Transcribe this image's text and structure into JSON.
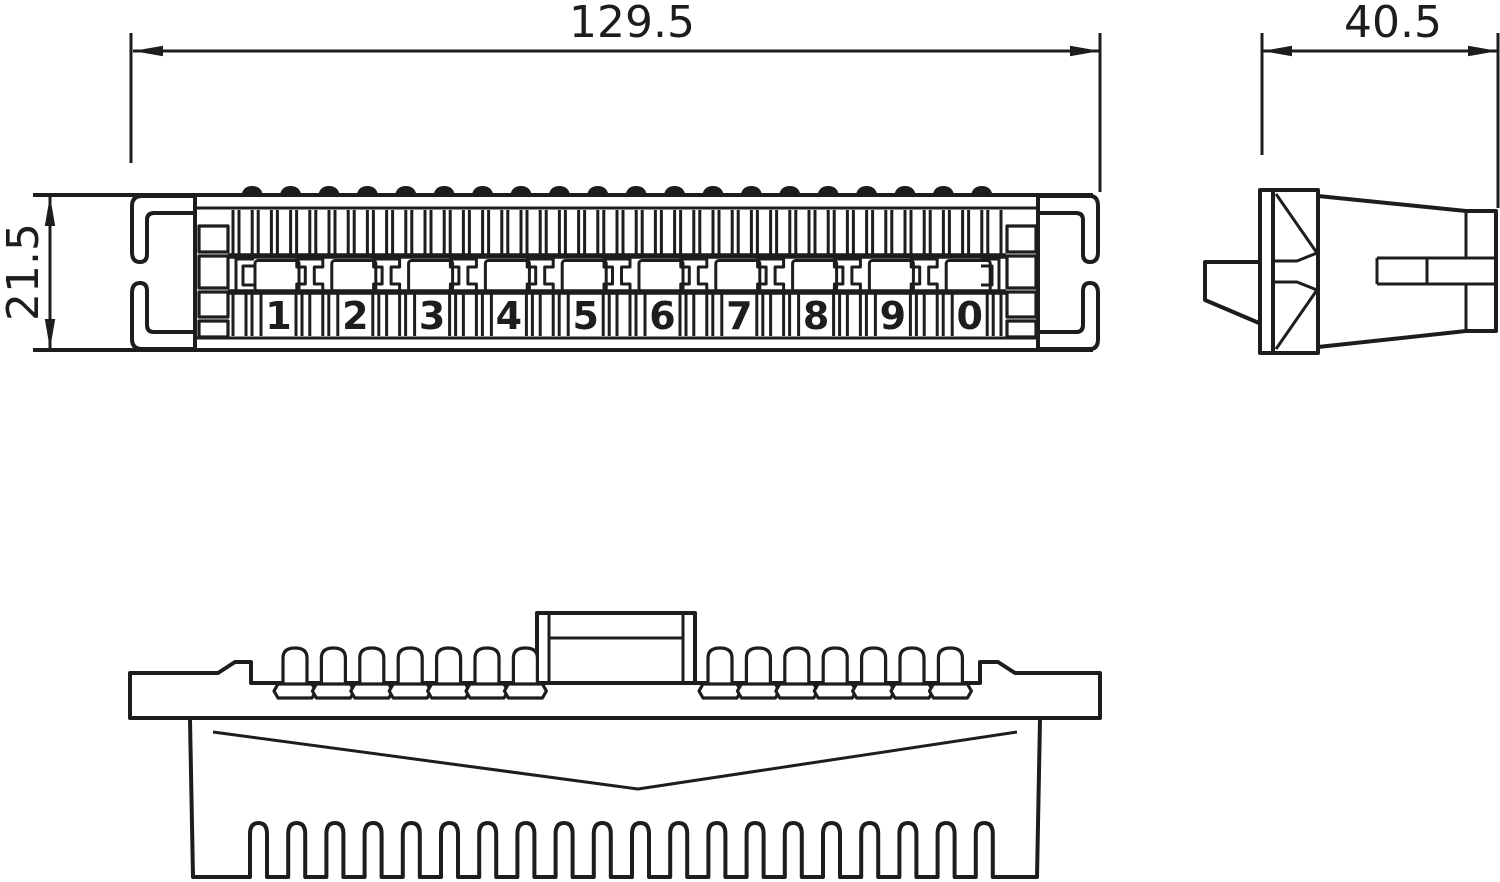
{
  "drawing": {
    "type": "three-view technical drawing of a 10-pair terminal connection strip",
    "colors": {
      "line": "#1d1d1b",
      "background": "#ffffff"
    },
    "views": {
      "front": {
        "name": "front-view",
        "dimension_width_label": "129.5",
        "dimension_height_label": "21.5",
        "pair_labels": [
          "1",
          "2",
          "3",
          "4",
          "5",
          "6",
          "7",
          "8",
          "9",
          "0"
        ],
        "pair_count": 10,
        "contact_bump_count": 20,
        "top_comb_cell_count": 40
      },
      "side": {
        "name": "side-view",
        "dimension_width_label": "40.5"
      },
      "bottom": {
        "name": "bottom-view",
        "pin_count_left": 7,
        "pin_count_right": 7,
        "comb_slot_count": 20
      }
    }
  }
}
